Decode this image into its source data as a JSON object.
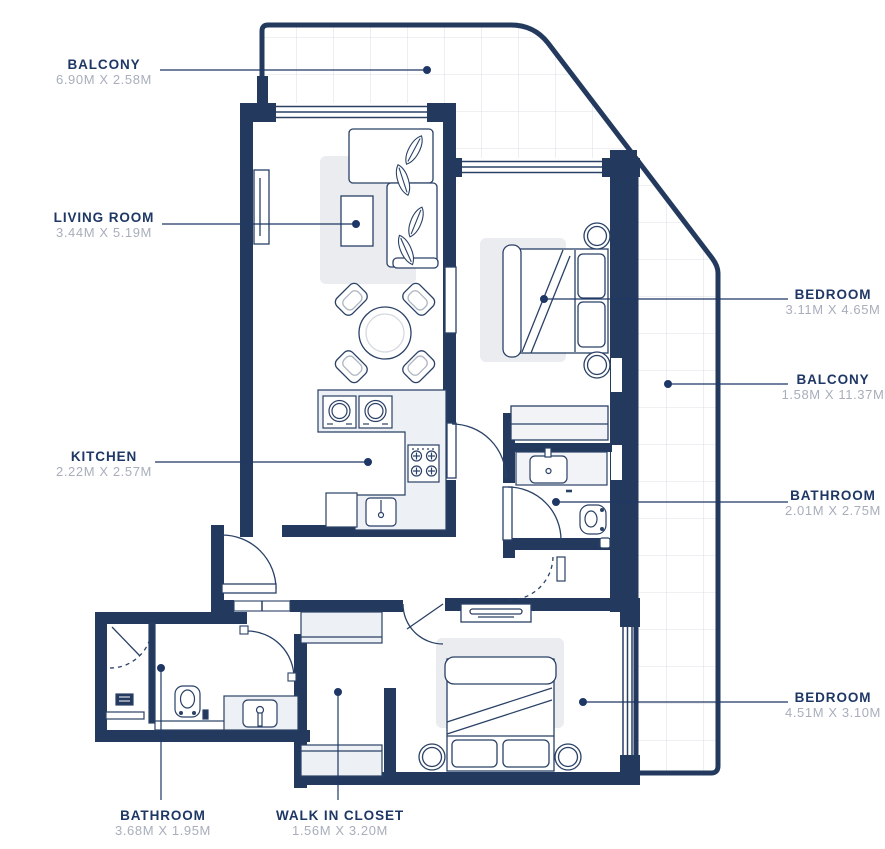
{
  "plan": {
    "type": "apartment-floor-plan",
    "colors": {
      "wall_navy": "#233A5E",
      "line_navy": "#2A4166",
      "dims_gray": "#A8AEBB",
      "label_navy": "#1E3765",
      "rug_gray": "#EAECEF",
      "counter_gray": "#EDF0F4",
      "grid_gray": "#DCE0E6"
    },
    "labels": [
      {
        "id": "balcony-top",
        "name": "BALCONY",
        "dims": "6.90M X 2.58M"
      },
      {
        "id": "living-room",
        "name": "LIVING ROOM",
        "dims": "3.44M X 5.19M"
      },
      {
        "id": "kitchen",
        "name": "KITCHEN",
        "dims": "2.22M X 2.57M"
      },
      {
        "id": "bedroom-1",
        "name": "BEDROOM",
        "dims": "3.11M X 4.65M"
      },
      {
        "id": "balcony-right",
        "name": "BALCONY",
        "dims": "1.58M X 11.37M"
      },
      {
        "id": "bathroom-1",
        "name": "BATHROOM",
        "dims": "2.01M X 2.75M"
      },
      {
        "id": "bedroom-2",
        "name": "BEDROOM",
        "dims": "4.51M X 3.10M"
      },
      {
        "id": "bathroom-2",
        "name": "BATHROOM",
        "dims": "3.68M X 1.95M"
      },
      {
        "id": "walk-in-closet",
        "name": "WALK IN CLOSET",
        "dims": "1.56M X 3.20M"
      }
    ]
  }
}
